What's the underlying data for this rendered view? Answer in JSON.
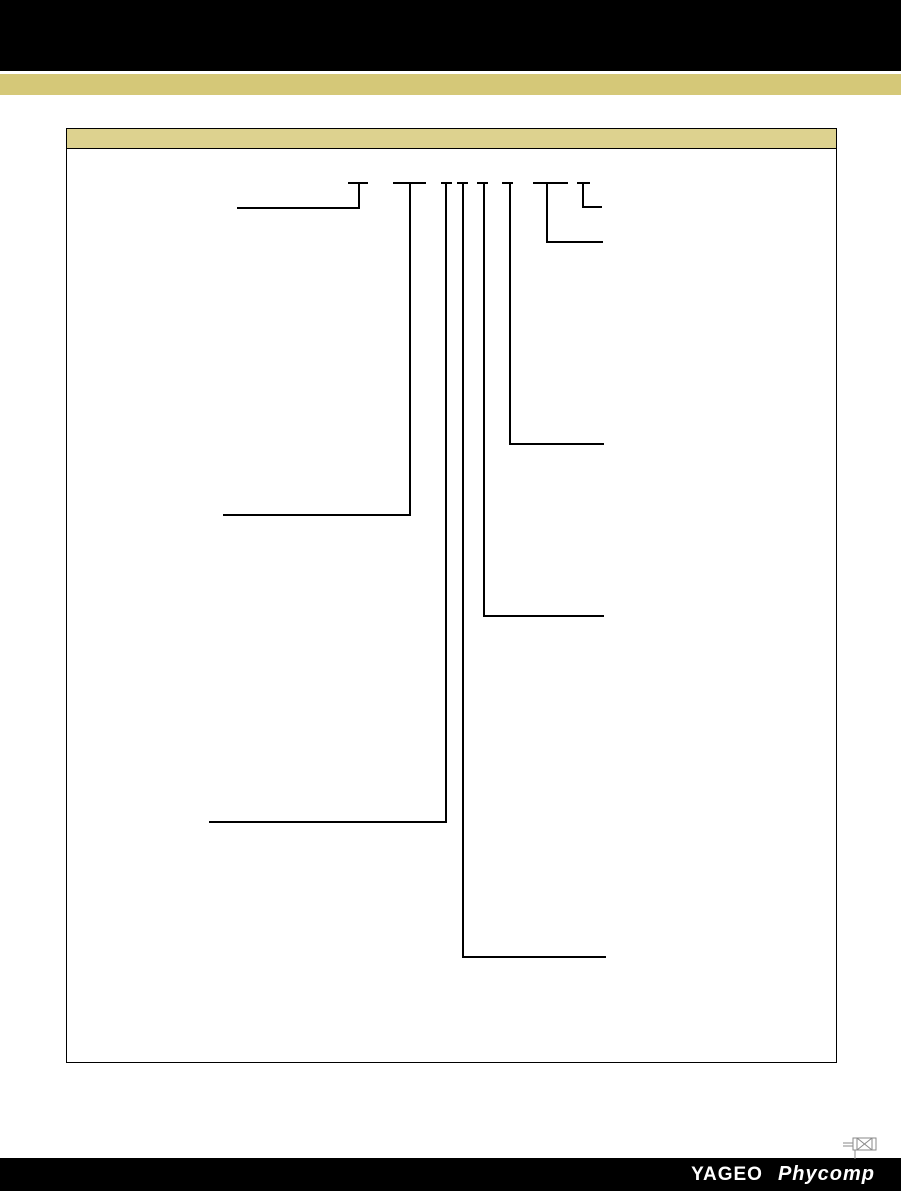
{
  "page": {
    "background": "#ffffff",
    "header_bar_color": "#000000",
    "accent_band_color": "#d5c878"
  },
  "panel": {
    "border_color": "#000000",
    "titlebar_color": "#ddd28f"
  },
  "diagram": {
    "line_color": "#000000",
    "thickness": 2,
    "leaders": [
      {
        "id": 1,
        "bar": [
          348,
          368,
          182
        ],
        "v": [
          358,
          182,
          209
        ],
        "h": [
          237,
          360,
          207
        ]
      },
      {
        "id": 2,
        "bar": [
          393,
          426,
          182
        ],
        "v": [
          409,
          182,
          516
        ],
        "h": [
          223,
          411,
          514
        ]
      },
      {
        "id": 3,
        "bar": [
          441,
          452,
          182
        ],
        "v": [
          445,
          182,
          823
        ],
        "h": [
          209,
          447,
          821
        ]
      },
      {
        "id": 4,
        "bar": [
          457,
          468,
          182
        ],
        "v": [
          462,
          182,
          958
        ],
        "h": [
          462,
          606,
          956
        ]
      },
      {
        "id": 5,
        "bar": [
          477,
          488,
          182
        ],
        "v": [
          483,
          182,
          617
        ],
        "h": [
          483,
          604,
          615
        ]
      },
      {
        "id": 6,
        "bar": [
          502,
          513,
          182
        ],
        "v": [
          509,
          182,
          445
        ],
        "h": [
          509,
          604,
          443
        ]
      },
      {
        "id": 7,
        "bar": [
          533,
          568,
          182
        ],
        "v": [
          546,
          182,
          243
        ],
        "h": [
          546,
          603,
          241
        ]
      },
      {
        "id": 8,
        "bar": [
          577,
          590,
          182
        ],
        "v": [
          582,
          182,
          208
        ],
        "h": [
          582,
          602,
          206
        ]
      }
    ]
  },
  "footer": {
    "bar_color": "#000000",
    "brand_primary": "YAGEO",
    "brand_secondary": "Phycomp",
    "icon_color": "#8a8a8a"
  }
}
